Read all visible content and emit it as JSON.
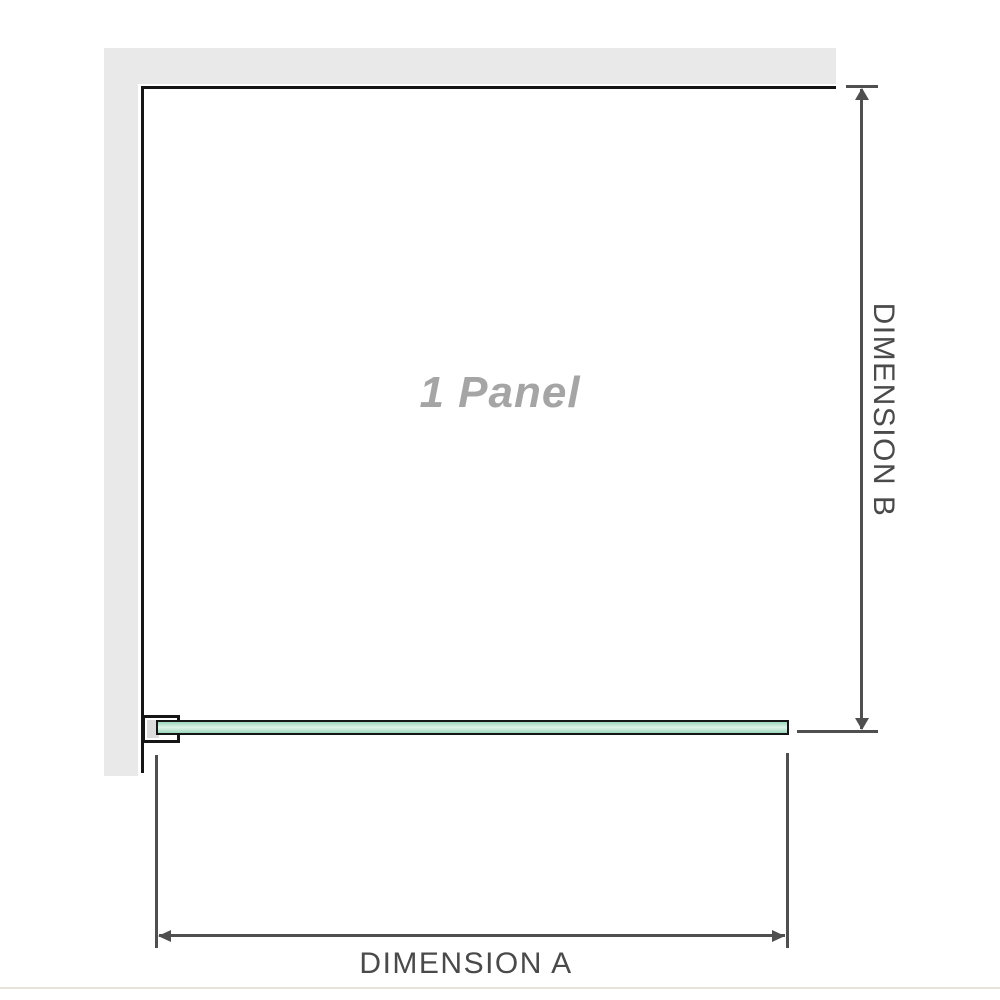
{
  "diagram": {
    "panel_label": "1 Panel",
    "dimensions": {
      "a_label": "DIMENSION A",
      "b_label": "DIMENSION B"
    },
    "colors": {
      "wall_gray": "#e9e9e9",
      "outline_black": "#151515",
      "dimension_gray": "#4f4f4f",
      "label_gray": "#4a4a4a",
      "panel_text_gray": "#a5a5a5",
      "glass_green": "#9cd8ba",
      "glass_green_light": "#def3e8",
      "bracket_fill": "#ffffff",
      "bracket_inner_gray": "#dcdcdc",
      "photo_edge": "#e6e3dc"
    }
  }
}
